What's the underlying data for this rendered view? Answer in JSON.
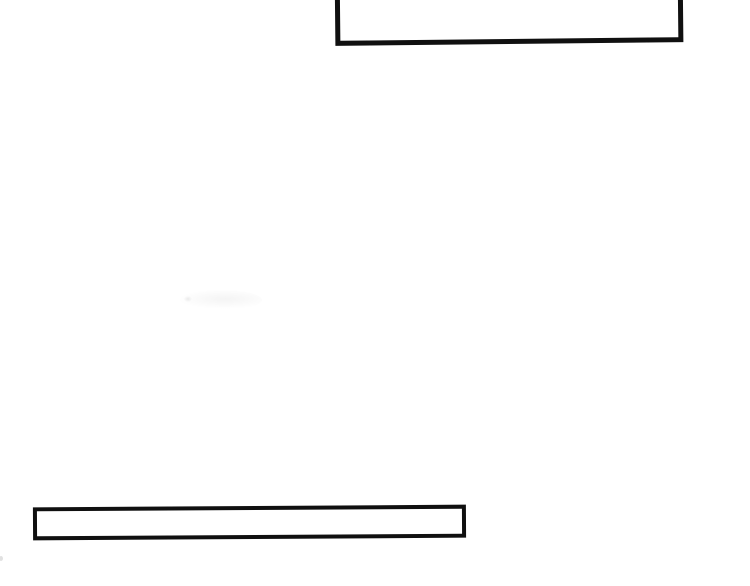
{
  "page": {
    "background_color": "#ffffff"
  },
  "colors": {
    "page_bg": "#ffffff",
    "box_border": "#101010",
    "box_fill": "#ffffff",
    "speck": "#d9d9d9"
  },
  "boxes": {
    "top_box": {
      "text": ""
    },
    "bottom_box": {
      "text": ""
    }
  }
}
